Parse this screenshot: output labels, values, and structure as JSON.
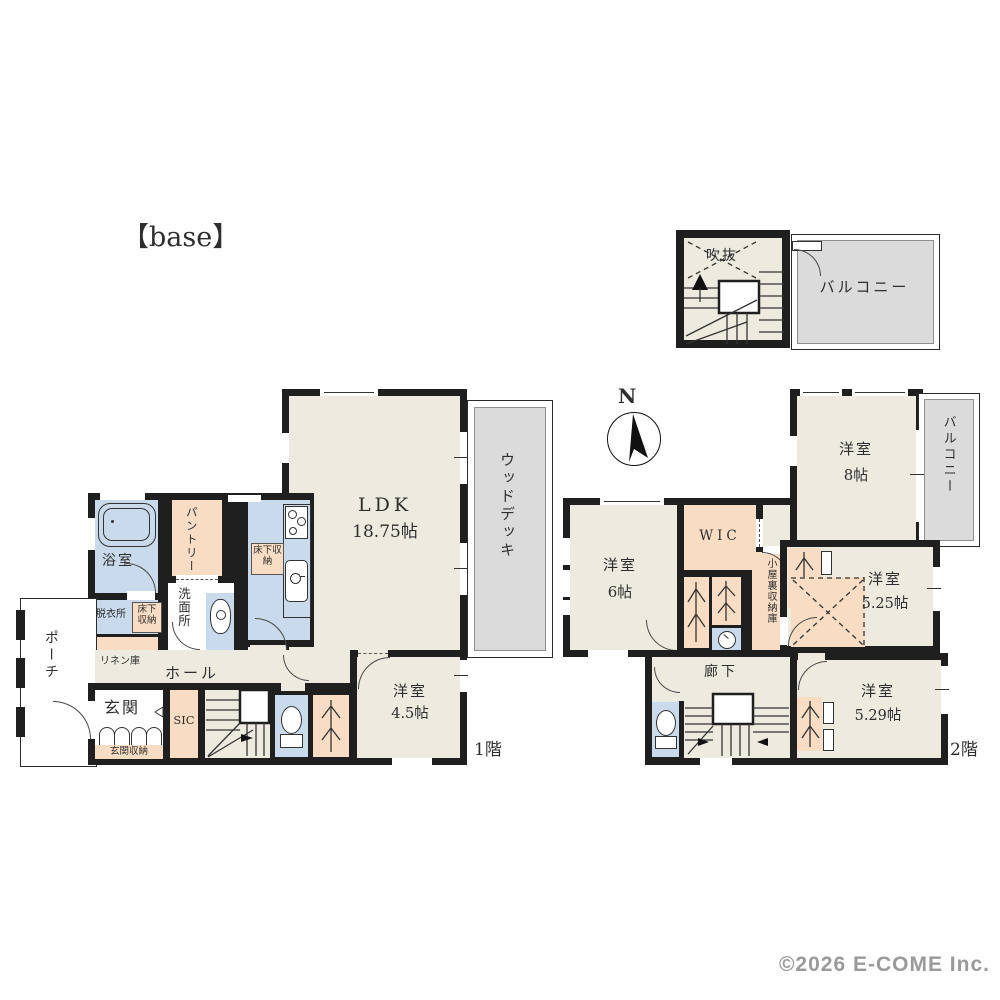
{
  "title": "【base】",
  "copyright": "©2026 E-COME Inc.",
  "compass": {
    "north_label": "N"
  },
  "attic": {
    "void_label": "吹抜",
    "balcony_label": "バルコニー"
  },
  "floor1": {
    "floor_label": "1階",
    "ldk": "LDK",
    "ldk_size": "18.75帖",
    "wood_deck": "ウッドデッキ",
    "bath": "浴室",
    "pantry": "パントリー",
    "washroom": "洗面所",
    "dressing_room": "脱衣所",
    "underfloor_storage_kitchen": "床下収納",
    "underfloor_storage_dressing": "床下収納",
    "linen": "リネン庫",
    "hall": "ホール",
    "porch": "ポーチ",
    "entrance": "玄関",
    "entrance_storage": "玄関収納",
    "sic": "SIC",
    "western_room": "洋室",
    "western_room_size": "4.5帖"
  },
  "floor2": {
    "floor_label": "2階",
    "western_room_8": "洋室",
    "western_room_8_size": "8帖",
    "balcony": "バルコニー",
    "western_room_6": "洋室",
    "western_room_6_size": "6帖",
    "wic": "WIC",
    "attic_storage": "小屋裏収納庫",
    "western_room_525": "洋室",
    "western_room_525_size": "5.25帖",
    "corridor": "廊下",
    "western_room_529": "洋室",
    "western_room_529_size": "5.29帖"
  },
  "colors": {
    "wall": "#1f1f1f",
    "room": "#EDEAE0",
    "wet": "#C8DAEC",
    "storage": "#F8DCC3",
    "outdoor": "#DBDBDB"
  }
}
